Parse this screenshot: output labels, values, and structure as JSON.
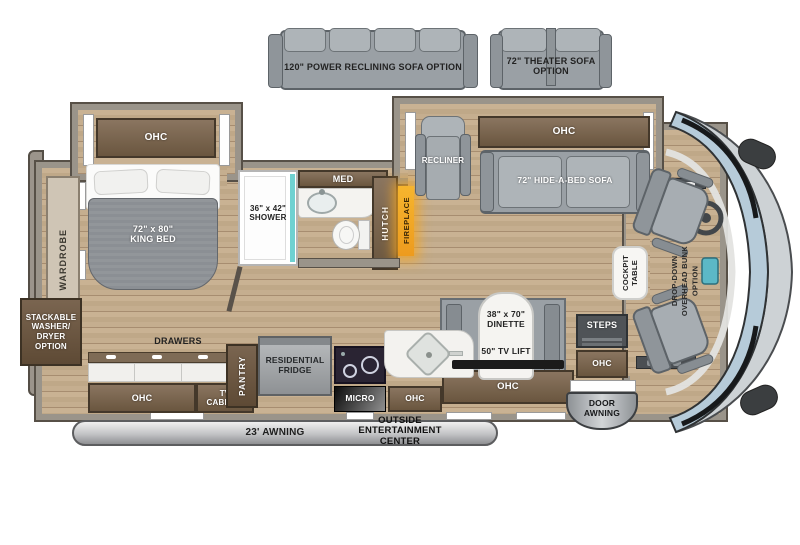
{
  "colors": {
    "floor_wood": "#c2ab8c",
    "wall_gray": "#9a948a",
    "cabinet_brown": "#73604b",
    "sofa_gray": "#9aa0a5",
    "shower_teal": "#6fd1d1",
    "fireplace_amber": "#f2a93b",
    "windshield_blue": "#b6cbd9"
  },
  "options": {
    "power_sofa": "120\" POWER RECLINING SOFA OPTION",
    "theater_sofa": "72\" THEATER SOFA\nOPTION"
  },
  "bedroom": {
    "ohc": "OHC",
    "king_bed": "72\" x 80\"\nKING BED",
    "wardrobe": "WARDROBE",
    "washer": "STACKABLE\nWASHER/\nDRYER\nOPTION",
    "drawers": "DRAWERS"
  },
  "bath": {
    "shower": "36\" x 42\"\nSHOWER",
    "med": "MED",
    "hutch": "HUTCH",
    "fireplace": "FIREPLACE"
  },
  "living": {
    "recliner": "RECLINER",
    "ohc": "OHC",
    "sofa": "72\" HIDE-A-BED SOFA"
  },
  "kitchen": {
    "ohc_left": "OHC",
    "tv_cabinet": "TV\nCABINET",
    "pantry": "PANTRY",
    "fridge": "RESIDENTIAL\nFRIDGE",
    "micro": "MICRO",
    "ohc_mid": "OHC"
  },
  "dinette": {
    "size": "38\" x 70\"\nDINETTE",
    "tv_lift": "50\" TV LIFT",
    "ohc": "OHC"
  },
  "entry": {
    "steps": "STEPS",
    "ohc": "OHC",
    "door_awning": "DOOR\nAWNING"
  },
  "cockpit": {
    "table": "COCKPIT\nTABLE",
    "bunk": "DROP-DOWN\nOVERHEAD BUNK\nOPTION"
  },
  "exterior": {
    "awning": "23' AWNING",
    "entertainment": "OUTSIDE\nENTERTAINMENT\nCENTER"
  }
}
